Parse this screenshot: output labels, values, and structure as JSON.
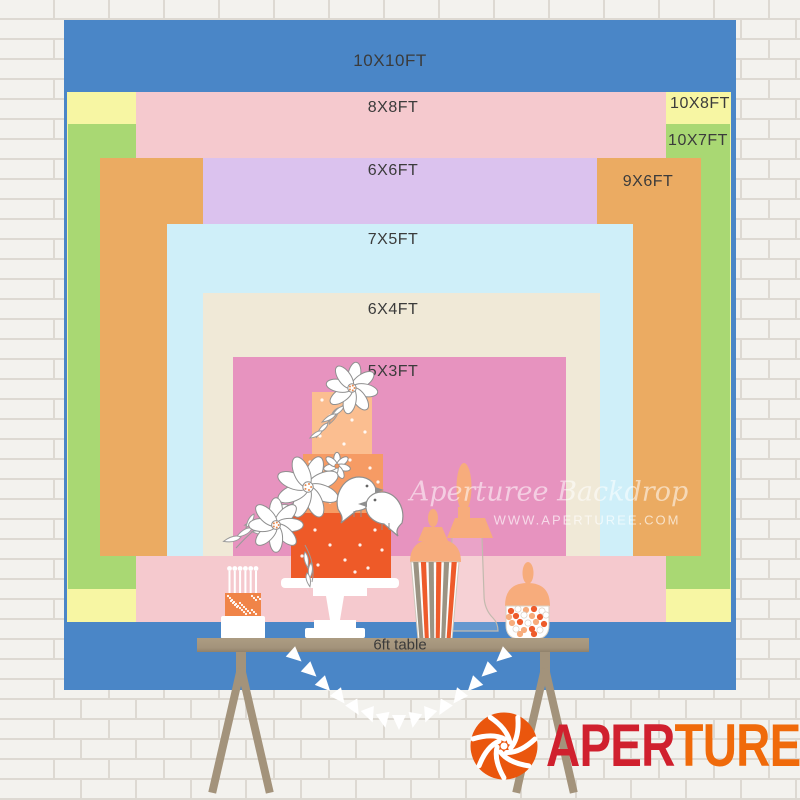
{
  "chart_data": {
    "type": "size-comparison",
    "unit": "ft",
    "title": "Backdrop size chart",
    "layers": [
      {
        "label": "10X10FT",
        "w_ft": 10,
        "h_ft": 10,
        "color": "#4A86C7",
        "x": 64,
        "y": 20,
        "w": 672,
        "h": 670,
        "lx": 390,
        "ly": 61
      },
      {
        "label": "10X8FT",
        "w_ft": 10,
        "h_ft": 8,
        "color": "#F7F6A3",
        "x": 67,
        "y": 92,
        "w": 664,
        "h": 530,
        "lx": 700,
        "ly": 104
      },
      {
        "label": "10X7FT",
        "w_ft": 10,
        "h_ft": 7,
        "color": "#A9D873",
        "x": 68,
        "y": 124,
        "w": 662,
        "h": 465,
        "lx": 698,
        "ly": 141
      },
      {
        "label": "8X8FT",
        "w_ft": 8,
        "h_ft": 8,
        "color": "#F5C9CE",
        "x": 136,
        "y": 92,
        "w": 530,
        "h": 530,
        "lx": 393,
        "ly": 108
      },
      {
        "label": "9X6FT",
        "w_ft": 9,
        "h_ft": 6,
        "color": "#EBAB62",
        "x": 100,
        "y": 158,
        "w": 601,
        "h": 398,
        "lx": 648,
        "ly": 182
      },
      {
        "label": "6X6FT",
        "w_ft": 6,
        "h_ft": 6,
        "color": "#DBC2EE",
        "x": 203,
        "y": 158,
        "w": 394,
        "h": 398,
        "lx": 393,
        "ly": 171
      },
      {
        "label": "7X5FT",
        "w_ft": 7,
        "h_ft": 5,
        "color": "#CFEFF9",
        "x": 167,
        "y": 224,
        "w": 466,
        "h": 332,
        "lx": 393,
        "ly": 240
      },
      {
        "label": "6X4FT",
        "w_ft": 6,
        "h_ft": 4,
        "color": "#F0E9D7",
        "x": 203,
        "y": 293,
        "w": 397,
        "h": 263,
        "lx": 393,
        "ly": 310
      },
      {
        "label": "5X3FT",
        "w_ft": 5,
        "h_ft": 3,
        "color": "#E793BF",
        "x": 233,
        "y": 357,
        "w": 333,
        "h": 199,
        "lx": 393,
        "ly": 372
      }
    ]
  },
  "table": {
    "label": "6ft table",
    "color": "#A3937B"
  },
  "watermark": {
    "line1": "Aperturee Backdrop",
    "line2": "WWW.APERTUREE.COM"
  },
  "logo": {
    "part1": "APER",
    "part2": "TUREE",
    "color1": "#D0202E",
    "color2": "#F06A0A",
    "icon_color": "#EA560D"
  },
  "scene": {
    "cake_tier_colors": [
      "#FBBE90",
      "#F69B64",
      "#EE5A28"
    ],
    "accent_peach": "#F7AC7C",
    "accent_orange": "#EE5B2B",
    "stripe_gray": "#9B9383",
    "mini_cake_color": "#F08448"
  }
}
